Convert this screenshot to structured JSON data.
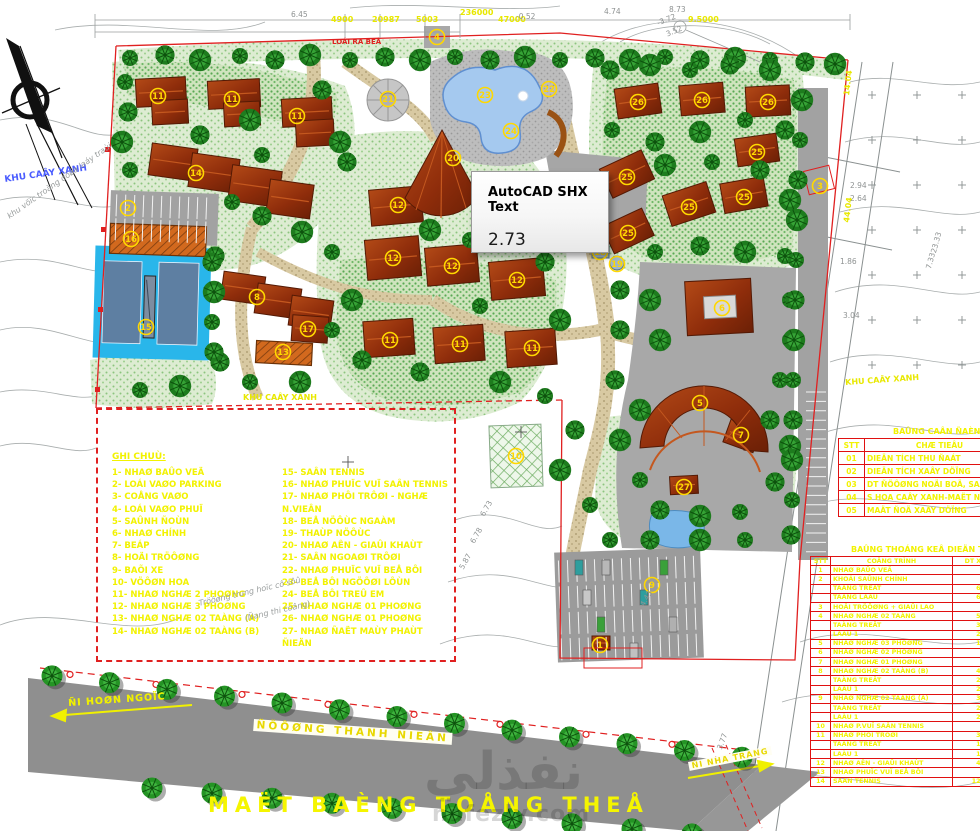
{
  "tooltip": {
    "title": "AutoCAD SHX Text",
    "value": "2.73"
  },
  "title": "MAËT BAÈNG TOÅNG THEÅ",
  "watermark": {
    "logo": "نفذلي",
    "domain": "nafezly.com"
  },
  "road": {
    "name": "ÑÖÔØNG THANH NIEÂN",
    "dir_left": "ÑI HOØN NGOÏC",
    "dir_right": "ÑI NHA TRANG"
  },
  "legend": {
    "title": "GHI CHUÙ:",
    "col1": [
      "1- NHAØ BAÛO VEÄ",
      "2- LOÁI VAØO PARKING",
      "3- COÅNG VAØO",
      "4- LOÁI VAØO PHUÏ",
      "5- SAÛNH ÑOÙN",
      "6- NHAØ CHÍNH",
      "7- BEÁP",
      "8- HOÄI TRÖÔØNG",
      "9- BAÕI XE",
      "10- VÖÔØN HOA",
      "11- NHAØ NGHÆ 2 PHOØNG",
      "12- NHAØ NGHÆ 3 PHOØNG",
      "13- NHAØ NGHÆ 02 TAÀNG (A)",
      "14- NHAØ NGHÆ 02 TAÀNG (B)"
    ],
    "col2": [
      "15- SAÂN TENNIS",
      "16- NHAØ PHUÏC VUÏ SAÂN TENNIS",
      "17- NHAØ PHÔI TRÔØI - NGHÆ N.VIEÂN",
      "18- BEÅ NÖÔÙC NGAÀM",
      "19- THAÙP NÖÔÙC",
      "20- NHAØ AÊN - GIAÛI KHAÙT",
      "21- SAÂN NGOAØI TRÔØI",
      "22- NHAØ PHUÏC VUÏ BEÅ BÔI",
      "23- BEÅ BÔI NGÖÔØI LÔÙN",
      "24- BEÅ BÔI TREÛ EM",
      "25- NHAØ NGHÆ 01 PHOØNG",
      "26- NHAØ NGHÆ 01 PHOØNG",
      "27- NHAØ ÑAËT MAÙY PHAÙT ÑIEÄN"
    ]
  },
  "tables": {
    "balance": {
      "title": "BAÛNG CAÂN ÑAÈNG ÑAÁT ÑAI",
      "headers": [
        "STT",
        "CHÆ TIEÂU",
        "DIEÄN TÍCH"
      ],
      "rows": [
        [
          "01",
          "DIEÄN TÍCH THU ÑAÁT",
          ""
        ],
        [
          "02",
          "DIEÄN TÍCH XAÂY DÖÏNG",
          ""
        ],
        [
          "03",
          "DT ÑÖÔØNG NOÄI BOÄ, SAÂN BAÕI",
          ""
        ],
        [
          "04",
          "S HOA CAÂY XANH-MAËT NÖÔÙC",
          ""
        ],
        [
          "05",
          "MAÄT ÑOÄ XAÂY DÖÏNG",
          ""
        ]
      ]
    },
    "stats": {
      "title": "BAÛNG THOÁNG KEÂ DIEÄN TÍCH",
      "headers": [
        "STT",
        "COÂNG TRÌNH",
        "DT XD",
        "S.LÖÔÏNG",
        "TOÅNG DT"
      ],
      "rows": [
        [
          "1",
          "NHAØ BAÛO VEÄ",
          "9.3",
          "01",
          "9.3"
        ],
        [
          "2",
          "KHOÁI SAÛNH CHÍNH",
          "",
          "01",
          "1.512"
        ],
        [
          "",
          "TAÀNG TREÄT",
          "699.0",
          "",
          ""
        ],
        [
          "",
          "TAÀNG LAÀU",
          "688.2",
          "",
          ""
        ],
        [
          "3",
          "HOÄI TRÖÔØNG + GIAÛI LAO",
          "",
          "01",
          "298.0"
        ],
        [
          "4",
          "NHAØ NGHÆ 02 TAÀNG",
          "571.1",
          "02",
          "1.040"
        ],
        [
          "",
          "TAÀNG TREÄT",
          "340.3",
          "",
          ""
        ],
        [
          "",
          "LAÀU 1",
          "230.8",
          "",
          ""
        ],
        [
          "5",
          "NHAØ NGHÆ 03 PHOØNG",
          "136.7",
          "04",
          "546.8"
        ],
        [
          "6",
          "NHAØ NGHÆ 02 PHOØNG",
          "94.9",
          "05",
          "474.5"
        ],
        [
          "7",
          "NHAØ NGHÆ 01 PHOØNG",
          "57.4",
          "06",
          "344.4"
        ],
        [
          "8",
          "NHAØ NGHÆ 02 TAÀNG (B)",
          "443.5",
          "01",
          "733.0"
        ],
        [
          "",
          "TAÀNG TREÄT",
          "232.5",
          "",
          ""
        ],
        [
          "",
          "LAÀU 1",
          "268.0",
          "",
          ""
        ],
        [
          "9",
          "NHAØ NGHÆ 02 TAÀNG (A)",
          "373.5",
          "01",
          "710.0"
        ],
        [
          "",
          "TAÀNG TREÄT",
          "232.5",
          "",
          ""
        ],
        [
          "",
          "LAÀU 1",
          "268.0",
          "",
          ""
        ],
        [
          "10",
          "NHAØ P.VUÏ SAÂN TENNIS",
          "63.2",
          "01",
          "63.2"
        ],
        [
          "11",
          "NHAØ PHÔI TRÔØI",
          "328.0",
          "01",
          "328.0"
        ],
        [
          "",
          "TAÀNG TREÄT",
          "166.0",
          "",
          ""
        ],
        [
          "",
          "LAÀU 1",
          "156.0",
          "",
          ""
        ],
        [
          "12",
          "NHAØ AÊN - GIAÛI KHAÙT",
          "460.0",
          "01",
          "460.0"
        ],
        [
          "13",
          "NHAØ PHUÏC VUÏ BEÅ BÔI",
          "72.9",
          "01",
          "72.9"
        ],
        [
          "14",
          "SAÂN TENNIS",
          "1248.6",
          "01",
          "1.248"
        ]
      ]
    }
  },
  "labels": [
    {
      "t": "4900",
      "x": 331,
      "y": 16,
      "c": "dim",
      "r": 0
    },
    {
      "t": "20987",
      "x": 372,
      "y": 16,
      "c": "dim",
      "r": 0
    },
    {
      "t": "5003",
      "x": 416,
      "y": 16,
      "c": "dim",
      "r": 0
    },
    {
      "t": "236000",
      "x": 460,
      "y": 9,
      "c": "dim",
      "r": 0
    },
    {
      "t": "47000",
      "x": 498,
      "y": 16,
      "c": "dim",
      "r": 0
    },
    {
      "t": "9.5000",
      "x": 688,
      "y": 16,
      "c": "dim",
      "r": 0
    },
    {
      "t": "6.45",
      "x": 291,
      "y": 11,
      "c": "gray",
      "r": 0
    },
    {
      "t": "-0.52",
      "x": 516,
      "y": 13,
      "c": "gray",
      "r": 0
    },
    {
      "t": "4.74",
      "x": 604,
      "y": 8,
      "c": "gray",
      "r": 0
    },
    {
      "t": "8.73",
      "x": 669,
      "y": 6,
      "c": "gray",
      "r": 0
    },
    {
      "t": "-3.72",
      "x": 656,
      "y": 20,
      "c": "gray",
      "r": -22
    },
    {
      "t": "3.52",
      "x": 665,
      "y": 31,
      "c": "gray",
      "r": -22
    },
    {
      "t": "LOÁI RA BEÅ",
      "x": 332,
      "y": 39,
      "c": "red",
      "r": 0
    },
    {
      "t": "KHU CAÂY XANH",
      "x": 4,
      "y": 176,
      "c": "blue",
      "r": -8
    },
    {
      "t": "khu vöïc troàng döøa laáy traùi",
      "x": 6,
      "y": 214,
      "c": "grayit",
      "r": -35
    },
    {
      "t": "KHU CAÂY XANH",
      "x": 243,
      "y": 394,
      "c": "dim",
      "r": 0
    },
    {
      "t": "KHU CAÂY XANH",
      "x": 845,
      "y": 379,
      "c": "dim",
      "r": -4
    },
    {
      "t": "2.94",
      "x": 850,
      "y": 182,
      "c": "gray",
      "r": 0
    },
    {
      "t": "2.64",
      "x": 850,
      "y": 195,
      "c": "gray",
      "r": 0
    },
    {
      "t": "1.86",
      "x": 840,
      "y": 258,
      "c": "gray",
      "r": 0
    },
    {
      "t": "3.04",
      "x": 843,
      "y": 312,
      "c": "gray",
      "r": 0
    },
    {
      "t": "14.04",
      "x": 843,
      "y": 95,
      "c": "dim",
      "r": -83
    },
    {
      "t": "44.04",
      "x": 843,
      "y": 222,
      "c": "dim",
      "r": -83
    },
    {
      "t": "23.33",
      "x": 930,
      "y": 252,
      "c": "gray",
      "r": -75
    },
    {
      "t": "7.33",
      "x": 925,
      "y": 268,
      "c": "gray",
      "r": -75
    },
    {
      "t": "6.73",
      "x": 479,
      "y": 514,
      "c": "gray",
      "r": -60
    },
    {
      "t": "6.78",
      "x": 469,
      "y": 541,
      "c": "gray",
      "r": -60
    },
    {
      "t": "5.87",
      "x": 458,
      "y": 567,
      "c": "gray",
      "r": -60
    },
    {
      "t": "4.43",
      "x": 639,
      "y": 604,
      "c": "gray",
      "r": -60
    },
    {
      "t": "3.77",
      "x": 716,
      "y": 748,
      "c": "gray",
      "r": -70
    },
    {
      "t": "Tröôøng trung hoïc cô sôû",
      "x": 198,
      "y": 600,
      "c": "grayit",
      "r": -13
    },
    {
      "t": "(Ñang thi coâng)",
      "x": 244,
      "y": 615,
      "c": "grayit",
      "r": -13
    },
    {
      "t": "ÑI HOØN NGOÏC",
      "x": 68,
      "y": 699,
      "c": "dimbig",
      "r": -4
    }
  ],
  "markers": [
    {
      "n": "11",
      "x": 158,
      "y": 96
    },
    {
      "n": "11",
      "x": 232,
      "y": 99
    },
    {
      "n": "11",
      "x": 297,
      "y": 116
    },
    {
      "n": "14",
      "x": 196,
      "y": 173
    },
    {
      "n": "2",
      "x": 128,
      "y": 208
    },
    {
      "n": "4",
      "x": 437,
      "y": 37
    },
    {
      "n": "16",
      "x": 131,
      "y": 239
    },
    {
      "n": "15",
      "x": 146,
      "y": 327
    },
    {
      "n": "13",
      "x": 283,
      "y": 352
    },
    {
      "n": "8",
      "x": 257,
      "y": 297
    },
    {
      "n": "17",
      "x": 308,
      "y": 329
    },
    {
      "n": "21",
      "x": 388,
      "y": 99
    },
    {
      "n": "23",
      "x": 485,
      "y": 95
    },
    {
      "n": "22",
      "x": 549,
      "y": 89
    },
    {
      "n": "24",
      "x": 511,
      "y": 131
    },
    {
      "n": "20",
      "x": 453,
      "y": 158
    },
    {
      "n": "12",
      "x": 398,
      "y": 205
    },
    {
      "n": "12",
      "x": 393,
      "y": 258
    },
    {
      "n": "12",
      "x": 452,
      "y": 266
    },
    {
      "n": "12",
      "x": 517,
      "y": 280
    },
    {
      "n": "11",
      "x": 390,
      "y": 340
    },
    {
      "n": "11",
      "x": 460,
      "y": 344
    },
    {
      "n": "11",
      "x": 532,
      "y": 348
    },
    {
      "n": "18",
      "x": 600,
      "y": 252
    },
    {
      "n": "19",
      "x": 617,
      "y": 264
    },
    {
      "n": "26",
      "x": 638,
      "y": 102
    },
    {
      "n": "26",
      "x": 702,
      "y": 100
    },
    {
      "n": "26",
      "x": 768,
      "y": 102
    },
    {
      "n": "25",
      "x": 627,
      "y": 177
    },
    {
      "n": "25",
      "x": 689,
      "y": 207
    },
    {
      "n": "25",
      "x": 744,
      "y": 197
    },
    {
      "n": "25",
      "x": 757,
      "y": 152
    },
    {
      "n": "25",
      "x": 628,
      "y": 233
    },
    {
      "n": "3",
      "x": 820,
      "y": 186
    },
    {
      "n": "6",
      "x": 722,
      "y": 308
    },
    {
      "n": "5",
      "x": 700,
      "y": 403
    },
    {
      "n": "7",
      "x": 741,
      "y": 435
    },
    {
      "n": "27",
      "x": 684,
      "y": 487
    },
    {
      "n": "10",
      "x": 516,
      "y": 456
    },
    {
      "n": "9",
      "x": 652,
      "y": 585
    },
    {
      "n": "1",
      "x": 600,
      "y": 645
    }
  ],
  "colors": {
    "boundary": "#e02020",
    "legend_text": "#f2f200",
    "roof": "#98320f",
    "tree": "#1e7c1e",
    "pool": "#a5c9ef",
    "tennis_water": "#29b6ea",
    "road": "#8f8f8f",
    "marker": "#ffd800"
  }
}
